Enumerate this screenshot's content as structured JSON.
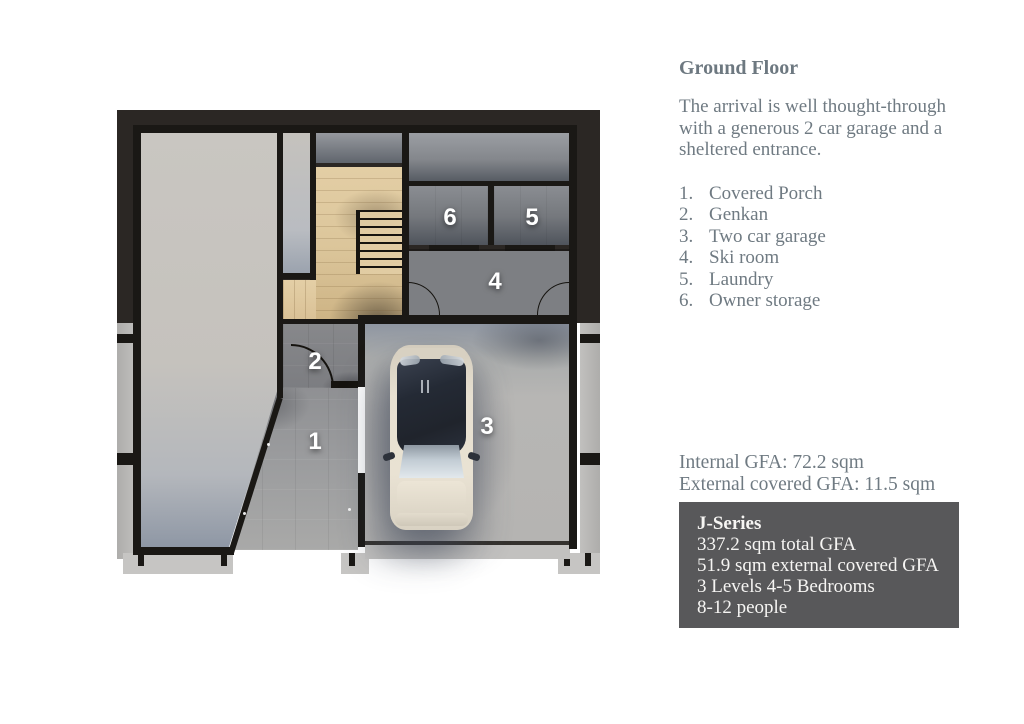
{
  "panel": {
    "title": "Ground Floor",
    "description": "The arrival is well thought-through with a generous 2 car garage and a sheltered entrance.",
    "legend": [
      {
        "num": "1.",
        "label": "Covered Porch"
      },
      {
        "num": "2.",
        "label": "Genkan"
      },
      {
        "num": "3.",
        "label": "Two car garage"
      },
      {
        "num": "4.",
        "label": "Ski room"
      },
      {
        "num": "5.",
        "label": "Laundry"
      },
      {
        "num": "6.",
        "label": "Owner storage"
      }
    ],
    "gfa": {
      "internal": "Internal GFA: 72.2 sqm",
      "external": "External covered GFA: 11.5 sqm"
    },
    "series_box": {
      "title": "J-Series",
      "lines": [
        "337.2 sqm total GFA",
        "51.9 sqm external covered GFA",
        "3 Levels 4-5 Bedrooms",
        "8-12 people"
      ]
    }
  },
  "floorplan": {
    "room_labels": [
      {
        "num": "1",
        "name": "Covered Porch"
      },
      {
        "num": "2",
        "name": "Genkan"
      },
      {
        "num": "3",
        "name": "Two car garage"
      },
      {
        "num": "4",
        "name": "Ski room"
      },
      {
        "num": "5",
        "name": "Laundry"
      },
      {
        "num": "6",
        "name": "Owner storage"
      }
    ],
    "colors": {
      "backdrop": "#2b2724",
      "wall": "#1a1815",
      "wood_floor": "#dcc69b",
      "concrete_light": "#c5c2bd",
      "tile_dark": "#7d7f83",
      "series_box_bg": "#58585a",
      "text_gray_blue": "#6f7a82",
      "car_body": "#e7e0d1",
      "car_roof": "#242a35"
    }
  }
}
